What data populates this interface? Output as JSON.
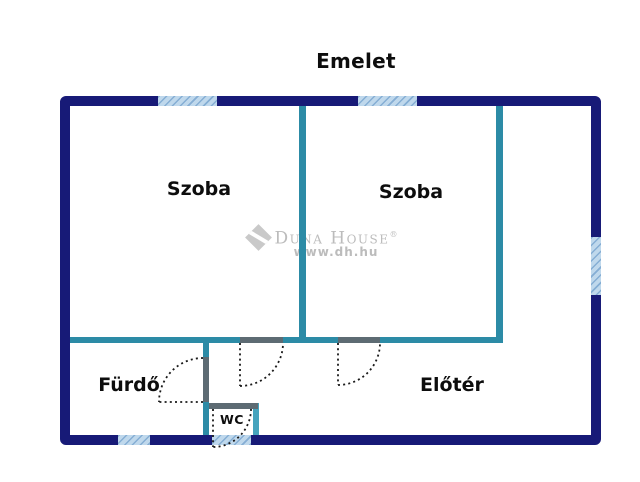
{
  "title": "Emelet",
  "rooms": {
    "szoba1": {
      "label": "Szoba"
    },
    "szoba2": {
      "label": "Szoba"
    },
    "furdo": {
      "label": "Fürdő"
    },
    "eloter": {
      "label": "Előtér"
    },
    "wc": {
      "label": "WC"
    }
  },
  "watermark": {
    "brand": "Duna House",
    "registered": "®",
    "url": "www.dh.hu",
    "logo_icon": "duna-house-diamond-logo"
  },
  "colors": {
    "background": "#ffffff",
    "outer_wall": "#171a77",
    "inner_wall": "#2c8ba6",
    "inner_wall_light": "#45a3bd",
    "door_header": "#5d6b73",
    "window_fill": "#bfd8ec",
    "window_hatch": "#85aed4",
    "door_swing": "#1a1a1a",
    "label": "#0d0d0d",
    "watermark": "#bcbcbc",
    "watermark_logo": "#c9c9c9"
  }
}
